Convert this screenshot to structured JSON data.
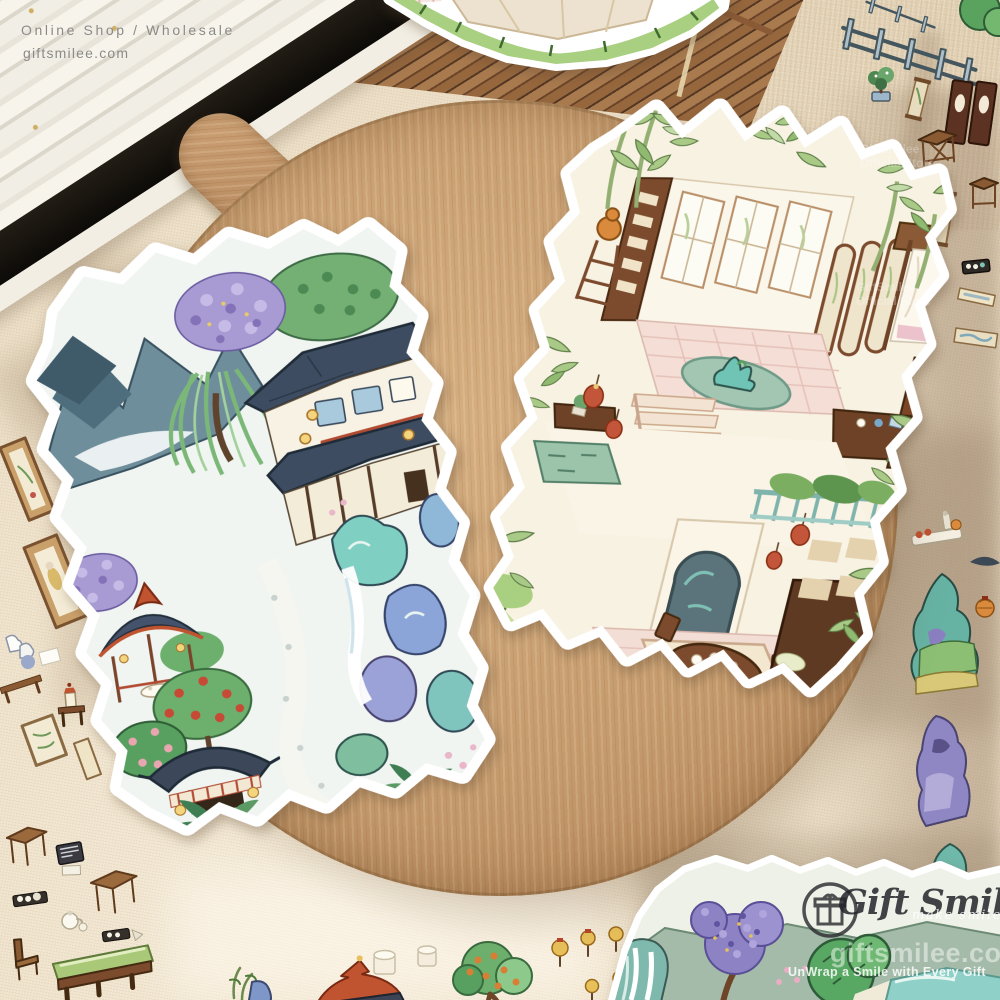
{
  "canvas": {
    "width": 1000,
    "height": 1000
  },
  "overlay_text": {
    "top_left_line1": "Online Shop / Wholesale",
    "top_left_line2": "giftsmilee.com",
    "text_color": "#8b8a86"
  },
  "brand_watermark": {
    "logo_icon": "gift-box-in-circle-icon",
    "brand_script": "Gift Smilee",
    "tagline": "make smile",
    "site": "giftsmilee.com",
    "slogan": "UnWrap a Smile with Every Gift",
    "faint_line1": "GiftSmilee",
    "faint_line2": "Official Store"
  },
  "scene": {
    "props": {
      "board": "round wooden serving board",
      "mat": "bamboo place mat",
      "fan": "white folding fan with black guard",
      "fabric": "cream gauze fabric backdrop"
    },
    "stickers": {
      "left_sheet": "chinese garden landscape die-cut sticker sheet",
      "right_sheet": "isometric chinese house interior die-cut sticker sheet",
      "top_partial": "courtyard floor sticker (partially visible)",
      "bottom_right_partial": "garden sticker with wisteria, tree and pond (partially visible)",
      "scatter_items": [
        "fence",
        "bonsai",
        "hanging scroll",
        "door panels",
        "wooden table",
        "wooden stool",
        "wooden chair",
        "bench",
        "tea tray",
        "teapot",
        "lanterns",
        "fruit tree",
        "pavilion roof",
        "framed paintings",
        "teal rock",
        "purple rock",
        "tray with bottles",
        "paper cups"
      ]
    },
    "palette": {
      "fabric": "#ecdfc6",
      "board_wood": "#c49a6c",
      "roof_slate": "#3e4c61",
      "vermilion": "#bf5433",
      "leaf_green": "#74b073",
      "teal_rock": "#7fd0c2",
      "wisteria_purple": "#a89ad2",
      "tile_pink": "#f4ded6",
      "wood_brown": "#7c4a2c",
      "ink_outline": "#2d3b49"
    }
  }
}
